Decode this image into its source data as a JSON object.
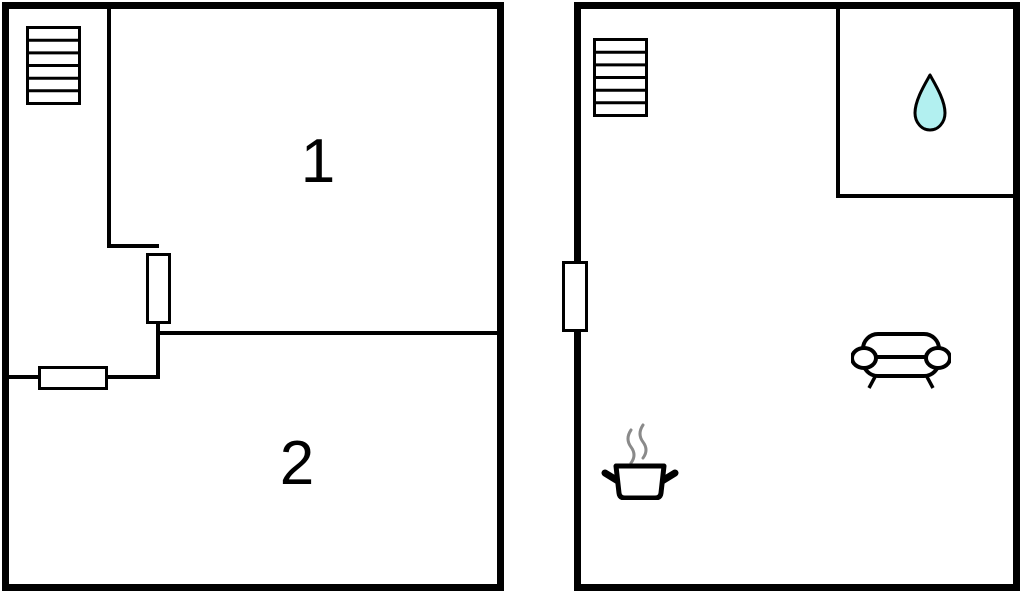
{
  "canvas": {
    "width": 1024,
    "height": 593,
    "background": "#ffffff"
  },
  "colors": {
    "wall": "#000000",
    "door_fill": "#ffffff",
    "drop_fill": "#b2f0f0",
    "drop_outline": "#000000",
    "steam": "#8a8a8a",
    "label_text": "#000000"
  },
  "left_plan": {
    "room_labels": [
      {
        "text": "1"
      },
      {
        "text": "2"
      }
    ],
    "icons": {
      "staircase": "staircase",
      "door_top": "door",
      "door_bottom": "door"
    }
  },
  "right_plan": {
    "icons": {
      "staircase": "staircase",
      "entry_door": "door",
      "water_drop": "water-drop",
      "sofa": "sofa",
      "cooking_pot": "cooking-pot"
    }
  }
}
